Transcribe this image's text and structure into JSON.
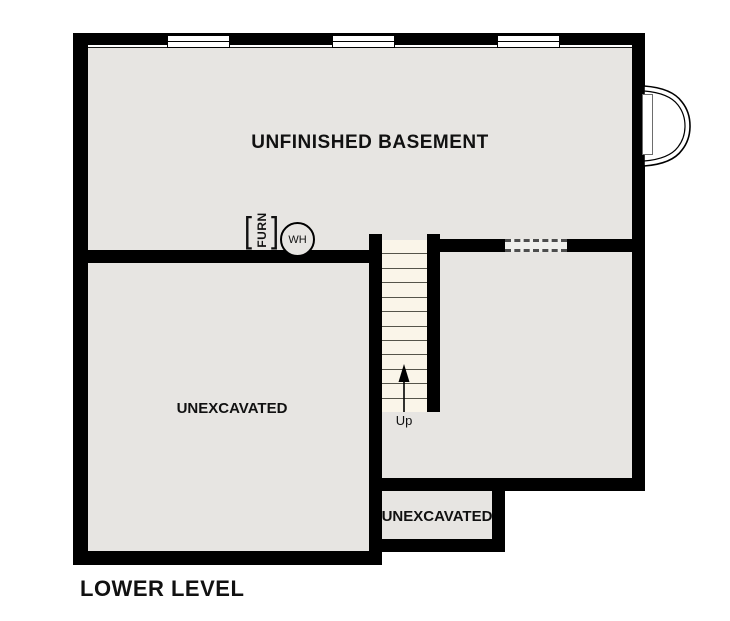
{
  "plan": {
    "title": "LOWER LEVEL",
    "rooms": {
      "basement": {
        "label": "UNFINISHED BASEMENT"
      },
      "left_unexcavated": {
        "label": "UNEXCAVATED"
      },
      "small_unexcavated": {
        "label": "UNEXCAVATED"
      }
    },
    "stairs": {
      "label": "Up",
      "direction": "up",
      "tread_count": 12
    },
    "equipment": {
      "furnace": {
        "label": "FURN",
        "bracket_left": "[",
        "bracket_right": "]"
      },
      "water_heater": {
        "label": "WH"
      }
    },
    "features": {
      "top_window_count": 3,
      "has_window_well": true,
      "has_dashed_opening": true
    },
    "colors": {
      "wall": "#000000",
      "floor": "#e7e5e2",
      "stair_floor": "#faf5e9",
      "background": "#ffffff",
      "text": "#111111"
    }
  }
}
